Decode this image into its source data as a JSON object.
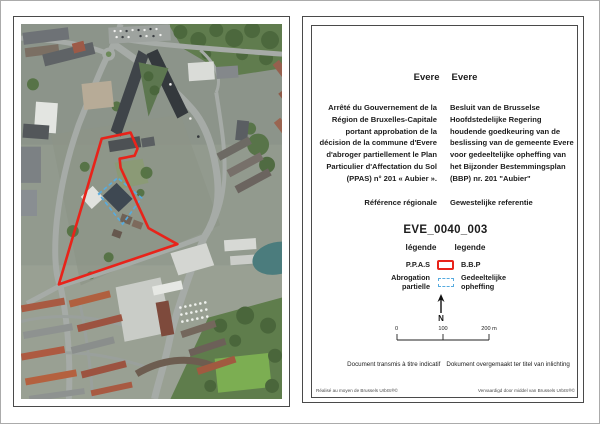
{
  "info_panel": {
    "commune_fr": "Evere",
    "commune_nl": "Evere",
    "decree_fr": "Arrêté du Gouvernement de la Région de Bruxelles-Capitale portant approbation de la décision de la commune d'Evere d'abroger partiellement le Plan Particulier d'Affectation du Sol (PPAS) n° 201 « Aubier ».",
    "decree_nl": "Besluit van de Brusselse Hoofdstedelijke Regering houdende goedkeuring van de beslissing van de gemeente Evere voor gedeeltelijke opheffing van het Bijzonder Bestemmingsplan (BBP)  nr. 201 \"Aubier\"",
    "reference_fr": "Référence régionale",
    "reference_nl": "Gewestelijke referentie",
    "reference_code": "EVE_0040_003",
    "legend_title_fr": "légende",
    "legend_title_nl": "legende",
    "legend": [
      {
        "label_fr": "P.P.A.S",
        "label_nl": "B.B.P",
        "swatch": "red-solid-outline"
      },
      {
        "label_fr": "Abrogation\npartielle",
        "label_nl": "Gedeeltelijke\nopheffing",
        "swatch": "blue-dashed-outline"
      }
    ],
    "north_label": "N",
    "scale": {
      "tick0": "0",
      "tick1": "100",
      "tick2": "200 m"
    },
    "disclaimer_fr": "Document transmis à titre indicatif",
    "disclaimer_nl": "Dokument overgemaakt ter titel van inlichting",
    "credit_fr": "Réalisé au moyen de Brussels UrbIS®©",
    "credit_nl": "Vervaardigd door middel van Brussels UrbIS®©"
  },
  "colors": {
    "ppas_outline": "#e8231a",
    "abrogation_outline": "#57abdf"
  }
}
